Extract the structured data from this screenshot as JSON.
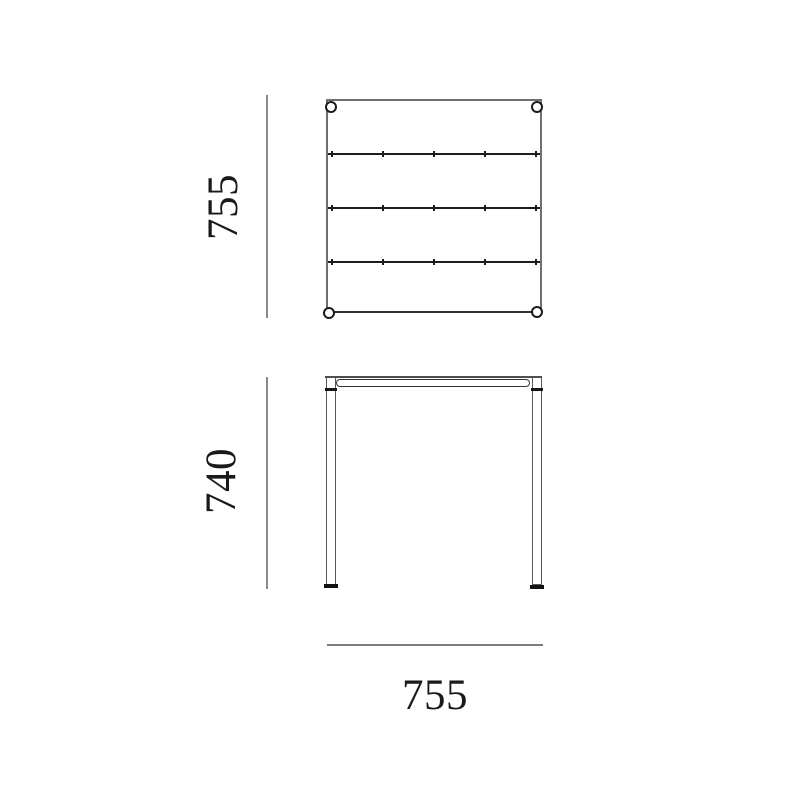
{
  "canvas": {
    "background": "#ffffff"
  },
  "style": {
    "outline_gray": "#6f6f6f",
    "outline_dark": "#2e2e2e",
    "divider_color": "#1d1d1d",
    "dimension_line_color": "#8a8a8a",
    "text_color": "#1a1a1c"
  },
  "top_view": {
    "height_dimension": "755",
    "slat_count": 4,
    "corner_fittings": 4
  },
  "front_view": {
    "height_dimension": "740",
    "width_dimension": "755"
  }
}
